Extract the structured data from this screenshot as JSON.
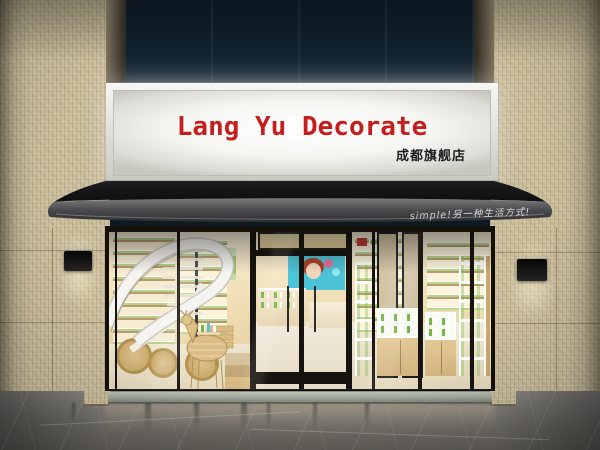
{
  "signboard": {
    "title": "Lang Yu Decorate",
    "subtitle": "成都旗舰店",
    "title_color": "#c41e1e",
    "subtitle_color": "#1d1d1d"
  },
  "awning": {
    "slogan": "simple!另一种生活方式!",
    "slogan_color": "#e4e4e4"
  },
  "palette": {
    "tile_beige": "#cbbf9d",
    "upper_glass_navy": "#12222e",
    "awning_gray": "#3a3a3d",
    "frame_black": "#17130e",
    "interior_wood": "#ecd8ac",
    "product_green": "#79b44a",
    "floor_gray": "#7e7b75",
    "sign_white": "#f5f5f2"
  }
}
